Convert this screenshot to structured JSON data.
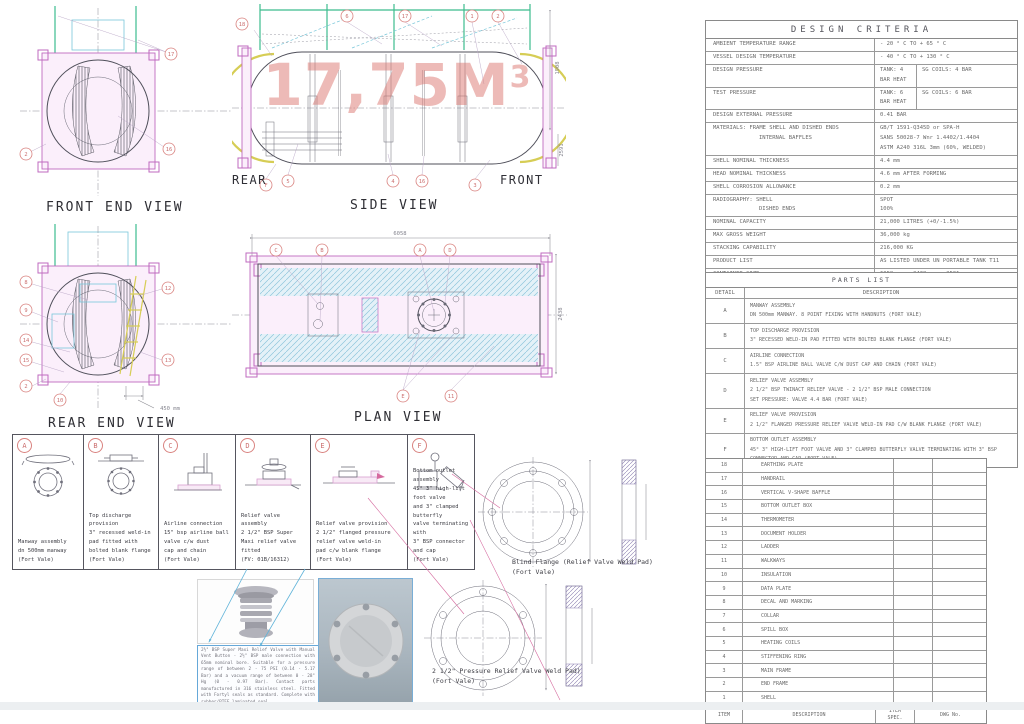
{
  "colors": {
    "frame_magenta": "#bf6abf",
    "tank_yellow": "#d6cd55",
    "rail_green": "#3cbc8e",
    "hatch_blue": "#8fc6dc",
    "balloon_red": "#d9827f",
    "watermark_red": "#db7670"
  },
  "views": {
    "front_end": {
      "title": "FRONT END VIEW",
      "balloons": [
        "17",
        "2",
        "16"
      ]
    },
    "side": {
      "title": "SIDE VIEW",
      "label_rear": "REAR",
      "label_front": "FRONT",
      "watermark": "17,75M",
      "watermark_sup": "3",
      "dim_top": "1908",
      "dim_right": "2591",
      "balloons_top": [
        "18",
        "6",
        "17",
        "1",
        "2"
      ],
      "balloons_bottom": [
        "F",
        "5",
        "4",
        "16",
        "3"
      ]
    },
    "rear_end": {
      "title": "REAR END VIEW",
      "dim": "450 mm",
      "balloons_left": [
        "8",
        "9",
        "14",
        "15",
        "2"
      ],
      "balloons_right": [
        "12",
        "13"
      ],
      "balloon_bottom": "10"
    },
    "plan": {
      "title": "PLAN VIEW",
      "dim_width": "6058",
      "dim_height": "2438",
      "balloons_top": [
        "C",
        "B",
        "A",
        "D"
      ],
      "balloons_bottom": [
        "E",
        "11"
      ]
    }
  },
  "details": [
    {
      "id": "A",
      "caption": "Manway assembly\ndn 500mm manway\n(Fort Vale)"
    },
    {
      "id": "B",
      "caption": "Top discharge provision\n3\" recessed weld-in\npad fitted with\nbolted blank flange\n(Fort Vale)"
    },
    {
      "id": "C",
      "caption": "Airline connection\n15\" bsp airline ball\nvalve c/w dust\ncap and chain\n(Fort Vale)"
    },
    {
      "id": "D",
      "caption": "Relief valve assembly\n2 1/2\" BSP Super\nMaxi relief valve fitted\n(FV: 01B/16312)"
    },
    {
      "id": "E",
      "caption": "Relief valve provision\n2 1/2\" flanged pressure\nrelief valve weld-in\npad c/w blank flange\n(Fort Vale)"
    },
    {
      "id": "F",
      "caption": "Bottom outlet assembly\n45° 3\" high-lift foot valve\nand 3\" clamped butterfly\nvalve terminating with\n3\" BSP connector and cap\n(Fort Vale)"
    }
  ],
  "photos": {
    "caption_p1": "2½\" BSP Super Maxi Relief Valve with Manual Vent Button - 2½\" BSP male connection with 65mm nominal bore. Suitable for a pressure range of between 2 - 75 PSI (0.14 - 5.17 Bar) and a vacuum range of between 0 - 28\" Hg (0 - 0.97 Bar). Contact parts manufactured in 316 stainless steel. Fitted with Fortyl seals as standard. Complete with rubber/PTFE laminated seal.",
    "caption_p2": "Options: Alternative seal materials are available. Cable vacuum actuator linkage available to clamp a vent button for remote operation."
  },
  "flanges": {
    "blind_label": "Blind Flange (Relief Valve Weld Pad)\n(Fort Vale)",
    "prv_label": "2 1/2\" Pressure Relief Valve Weld Pad)\n(Fort Vale)"
  },
  "design_criteria": {
    "title": "DESIGN CRITERIA",
    "rows": [
      {
        "label": "AMBIENT TEMPERATURE RANGE",
        "value": "- 20 ° C TO + 65 ° C"
      },
      {
        "label": "VESSEL DESIGN TEMPERATURE",
        "value": "- 40 ° C TO + 130 ° C"
      },
      {
        "label": "DESIGN PRESSURE",
        "value": "TANK: 4 BAR HEAT",
        "value2": "SG COILS: 4 BAR"
      },
      {
        "label": "TEST PRESSURE",
        "value": "TANK: 6 BAR HEAT",
        "value2": "SG COILS: 6 BAR"
      },
      {
        "label": "DESIGN EXTERNAL PRESSURE",
        "value": "0.41 BAR"
      },
      {
        "label": "MATERIALS: FRAME SHELL AND DISHED ENDS",
        "sublabel": "INTERNAL BAFFLES",
        "value": "GB/T 1591-Q345D or SPA-H\nSANS 50028-7 Wnr 1.4402/1.4404\nASTM A240 316L 3mm (60%, WELDED)"
      },
      {
        "label": "SHELL NOMINAL THICKNESS",
        "value": "4.4 mm"
      },
      {
        "label": "HEAD NOMINAL THICKNESS",
        "value": "4.6 mm AFTER FORMING"
      },
      {
        "label": "SHELL CORROSION ALLOWANCE",
        "value": "0.2 mm"
      },
      {
        "label": "RADIOGRAPHY: SHELL",
        "sublabel": "DISHED ENDS",
        "value": "SPOT\n100%"
      },
      {
        "label": "NOMINAL CAPACITY",
        "value": "21,000 LITRES (+0/-1.5%)"
      },
      {
        "label": "MAX GROSS WEIGHT",
        "value": "36,000 kg"
      },
      {
        "label": "STACKING CAPABILITY",
        "value": "216,000 KG"
      },
      {
        "label": "PRODUCT LIST",
        "value": "AS LISTED UNDER UN PORTABLE TANK T11"
      },
      {
        "label": "CONTAINER SIZE",
        "value": "6058 mm x 2438 mm x 2591 mm"
      },
      {
        "label": "INSULATION",
        "value": "ROCKWOOL"
      },
      {
        "label": "CLADDING",
        "value": "GRP"
      },
      {
        "label": "FRAME FINISH",
        "value": "SHOT BLAST SA2.5: 3 COAT PAINT SYSTEM"
      },
      {
        "label": "INSPECTION AUTHORITY",
        "value": "LR"
      }
    ]
  },
  "parts_list": {
    "title": "PARTS LIST",
    "col_detail": "DETAIL",
    "col_description": "DESCRIPTION",
    "rows": [
      {
        "id": "A",
        "desc": "MANWAY ASSEMBLY\nDN 500mm MANWAY. 8 POINT FIXING WITH HANDNUTS (FORT VALE)"
      },
      {
        "id": "B",
        "desc": "TOP DISCHARGE PROVISION\n3\" RECESSED WELD-IN PAD FITTED WITH BOLTED BLANK FLANGE (FORT VALE)"
      },
      {
        "id": "C",
        "desc": "AIRLINE CONNECTION\n1.5\" BSP AIRLINE BALL VALVE C/W DUST CAP AND CHAIN (FORT VALE)"
      },
      {
        "id": "D",
        "desc": "RELIEF VALVE ASSEMBLY\n2 1/2\" BSP TWINACT RELIEF VALVE - 2 1/2\" BSP MALE CONNECTION\nSET PRESSURE: VALVE 4.4 BAR (FORT VALE)"
      },
      {
        "id": "E",
        "desc": "RELIEF VALVE PROVISION\n2 1/2\" FLANGED PRESSURE RELIEF VALVE WELD-IN PAD C/W BLANK FLANGE (FORT VALE)"
      },
      {
        "id": "F",
        "desc": "BOTTOM OUTLET ASSEMBLY\n45° 3\" HIGH-LIFT FOOT VALVE AND 3\" CLAMPED BUTTERFLY VALVE TERMINATING WITH 3\" BSP\nCONNECTOR AND CAP (FORT VALE)"
      }
    ]
  },
  "items_table": {
    "rows": [
      {
        "num": "18",
        "name": "EARTHING PLATE"
      },
      {
        "num": "17",
        "name": "HANDRAIL"
      },
      {
        "num": "16",
        "name": "VERTICAL V-SHAPE BAFFLE"
      },
      {
        "num": "15",
        "name": "BOTTOM OUTLET BOX"
      },
      {
        "num": "14",
        "name": "THERMOMETER"
      },
      {
        "num": "13",
        "name": "DOCUMENT HOLDER"
      },
      {
        "num": "12",
        "name": "LADDER"
      },
      {
        "num": "11",
        "name": "WALKWAYS"
      },
      {
        "num": "10",
        "name": "INSULATION"
      },
      {
        "num": "9",
        "name": "DATA PLATE"
      },
      {
        "num": "8",
        "name": "DECAL AND MARKING"
      },
      {
        "num": "7",
        "name": "COLLAR"
      },
      {
        "num": "6",
        "name": "SPILL BOX"
      },
      {
        "num": "5",
        "name": "HEATING COILS"
      },
      {
        "num": "4",
        "name": "STIFFENING RING"
      },
      {
        "num": "3",
        "name": "MAIN FRAME"
      },
      {
        "num": "2",
        "name": "END FRAME"
      },
      {
        "num": "1",
        "name": "SHELL"
      }
    ],
    "footer": {
      "item": "ITEM",
      "description": "DESCRIPTION",
      "spec": "ITEM\nSPEC.",
      "dwg": "DWG No."
    }
  }
}
